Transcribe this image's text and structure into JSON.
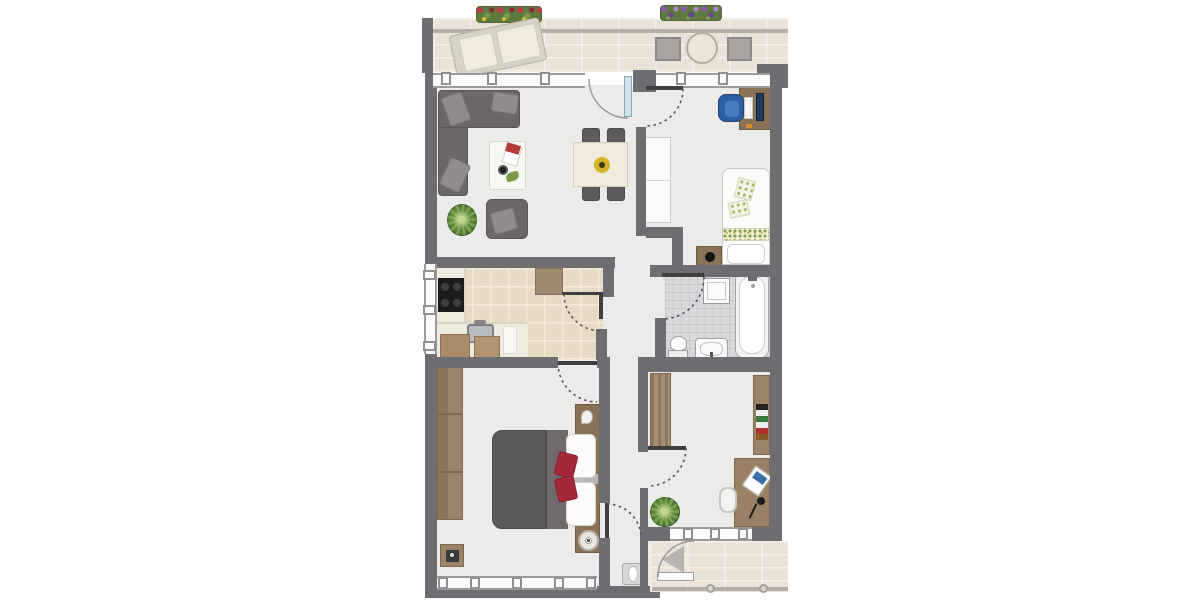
{
  "scene": {
    "type": "apartment-floor-plan",
    "description": "Top-down 2D floor plan of a two-bedroom apartment with two balconies, living-dining room, kitchen, bathroom, hallway and study; no text labels rendered."
  },
  "colors": {
    "wall": "#6e6d71",
    "floor": "#ebebe9",
    "balconyTile": "#eae2d6",
    "grout": "#f5f0e8",
    "kitchenTile": "#e8d9c5",
    "kitchenGrout": "#f3e9db",
    "bathTile": "#d9d9dc",
    "bathGrout": "#c9c9cd",
    "frame": "#9b9b9b",
    "glass": "#cfe2ec",
    "sofa": "#6b6767",
    "cushion": "#908c8c",
    "wood": "#9b8366",
    "woodDark": "#8a7257",
    "duvet": "#5c595b",
    "accentRed": "#a5283a",
    "chairBlue": "#2f5fa3",
    "tableCream": "#efead9",
    "plantDark": "#4e7430",
    "plantLight": "#86ad58"
  },
  "rooms": {
    "balcony_top": {
      "label": "Balcony (top)",
      "furniture": [
        "flower box red",
        "flower box purple",
        "double sun lounger",
        "round table",
        "two chairs"
      ]
    },
    "living_dining": {
      "label": "Living / dining room",
      "furniture": [
        "corner sofa with cushions",
        "coffee table with magazines and cup",
        "armchair",
        "potted plant",
        "dining table with fruit bowl",
        "four dining chairs",
        "glass balcony door"
      ]
    },
    "bedroom2": {
      "label": "Bedroom / office (top right)",
      "furniture": [
        "white wardrobe",
        "desk with monitor and keyboard",
        "blue office chair",
        "single bed with floral runner and cushions",
        "nightstand with lamp"
      ]
    },
    "kitchen": {
      "label": "Kitchen",
      "furniture": [
        "cooktop",
        "counter with sink",
        "cutting boards",
        "cabinet",
        "window"
      ]
    },
    "bathroom": {
      "label": "Bathroom",
      "furniture": [
        "washing machine",
        "bathtub",
        "toilet",
        "washbasin"
      ]
    },
    "hallway": {
      "label": "Hallway",
      "furniture": [
        "wall fixture"
      ]
    },
    "bedroom1": {
      "label": "Bedroom (bottom left)",
      "furniture": [
        "wardrobe",
        "double bed with dark duvet",
        "two white pillows",
        "two red cushions",
        "headboard with nightstands",
        "round lamp",
        "stool"
      ]
    },
    "study": {
      "label": "Room (bottom right)",
      "furniture": [
        "open wardrobe",
        "bookshelf",
        "desk with laptop and lamp",
        "desk chair",
        "potted plant"
      ]
    },
    "balcony_bottom": {
      "label": "Balcony (bottom)",
      "furniture": [
        "railing with posts",
        "balcony door"
      ]
    }
  },
  "arcs": [
    {
      "name": "living-balcony-door-swing",
      "dotted": false,
      "d": "M589,79 A39,39 0 0 0 628,118"
    },
    {
      "name": "bedroom2-door-swing",
      "dotted": true,
      "d": "M683,89 A37,37 0 0 1 646,126"
    },
    {
      "name": "bathroom-door-swing",
      "dotted": true,
      "d": "M704,277 A42,42 0 0 1 662,319"
    },
    {
      "name": "kitchen-door-swing",
      "dotted": true,
      "d": "M564,294 A37,37 0 0 0 601,331"
    },
    {
      "name": "bedroom1-door-swing",
      "dotted": true,
      "d": "M558,363 A39,39 0 0 0 597,402"
    },
    {
      "name": "bedroom1-hall-door-swing",
      "dotted": true,
      "d": "M607,504 A34,34 0 0 1 641,538"
    },
    {
      "name": "study-door-swing",
      "dotted": true,
      "d": "M686,448 A38,38 0 0 1 648,486"
    },
    {
      "name": "balcony-bottom-door-swing",
      "dotted": false,
      "d": "M658,577 A36,36 0 0 1 694,541"
    }
  ]
}
